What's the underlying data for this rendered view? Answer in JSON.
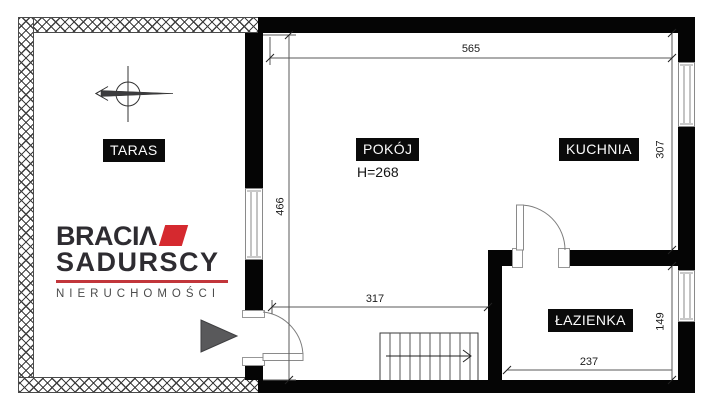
{
  "rooms": {
    "taras": {
      "label": "TARAS"
    },
    "pokoj": {
      "label": "POKÓJ",
      "height_note": "H=268"
    },
    "kuchnia": {
      "label": "KUCHNIA"
    },
    "lazienka": {
      "label": "ŁAZIENKA"
    }
  },
  "dimensions": {
    "top_width": "565",
    "kitchen_depth": "307",
    "bathroom_depth": "149",
    "room_depth": "466",
    "room_width": "317",
    "bathroom_width": "237"
  },
  "logo": {
    "line1": "BRACIΛ",
    "line2": "SADURSCY",
    "line3": "NIERUCHOMOŚCI"
  },
  "colors": {
    "wall": "#050505",
    "accent_red": "#d5292f",
    "divider_red": "#c2363b",
    "logo_text": "#2e2c31",
    "marker_gray": "#59595b"
  }
}
